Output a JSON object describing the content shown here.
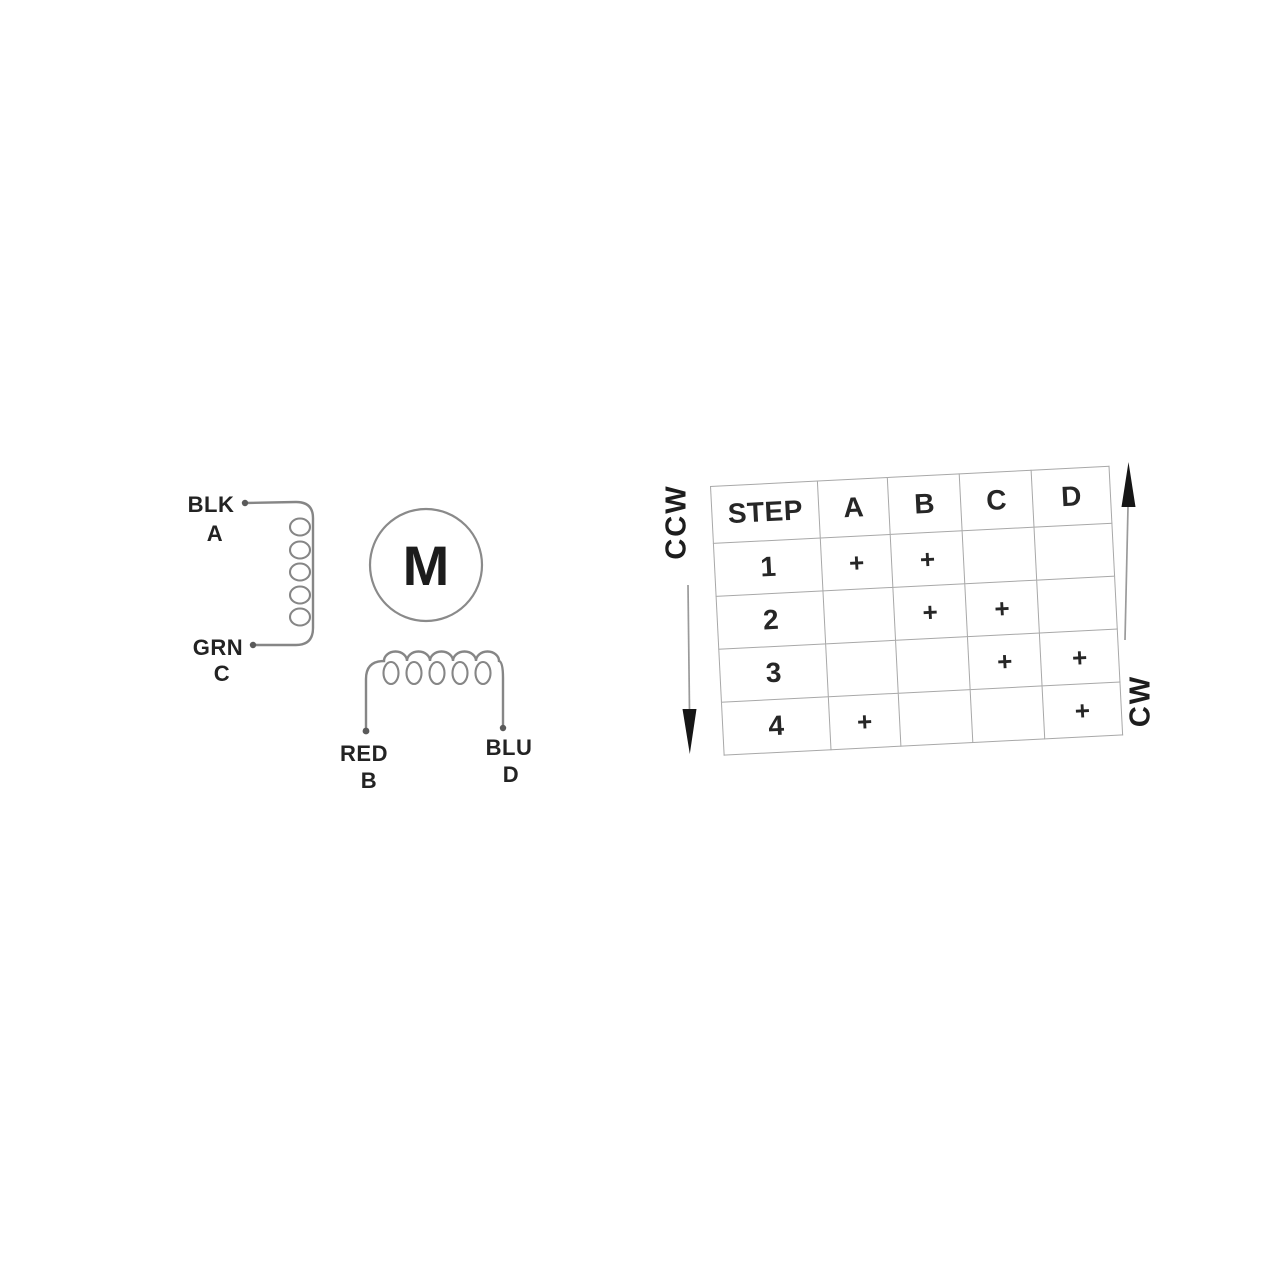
{
  "colors": {
    "background": "#ffffff",
    "wire_gray": "#868686",
    "grid_gray": "#a8a8a8",
    "label_dark": "#232323",
    "arrow_black": "#161616"
  },
  "motor_diagram": {
    "motor_symbol": "M",
    "winding_ac": {
      "top_wire_color_label": "BLK",
      "top_terminal": "A",
      "bottom_wire_color_label": "GRN",
      "bottom_terminal": "C"
    },
    "winding_bd": {
      "left_wire_color_label": "RED",
      "left_terminal": "B",
      "right_wire_color_label": "BLU",
      "right_terminal": "D"
    }
  },
  "step_table": {
    "headers": [
      "STEP",
      "A",
      "B",
      "C",
      "D"
    ],
    "rows": [
      [
        "1",
        "+",
        "+",
        "",
        ""
      ],
      [
        "2",
        "",
        "+",
        "+",
        ""
      ],
      [
        "3",
        "",
        "",
        "+",
        "+"
      ],
      [
        "4",
        "+",
        "",
        "",
        "+"
      ]
    ]
  },
  "direction_indicators": {
    "ccw_label": "CCW",
    "cw_label": "CW"
  }
}
